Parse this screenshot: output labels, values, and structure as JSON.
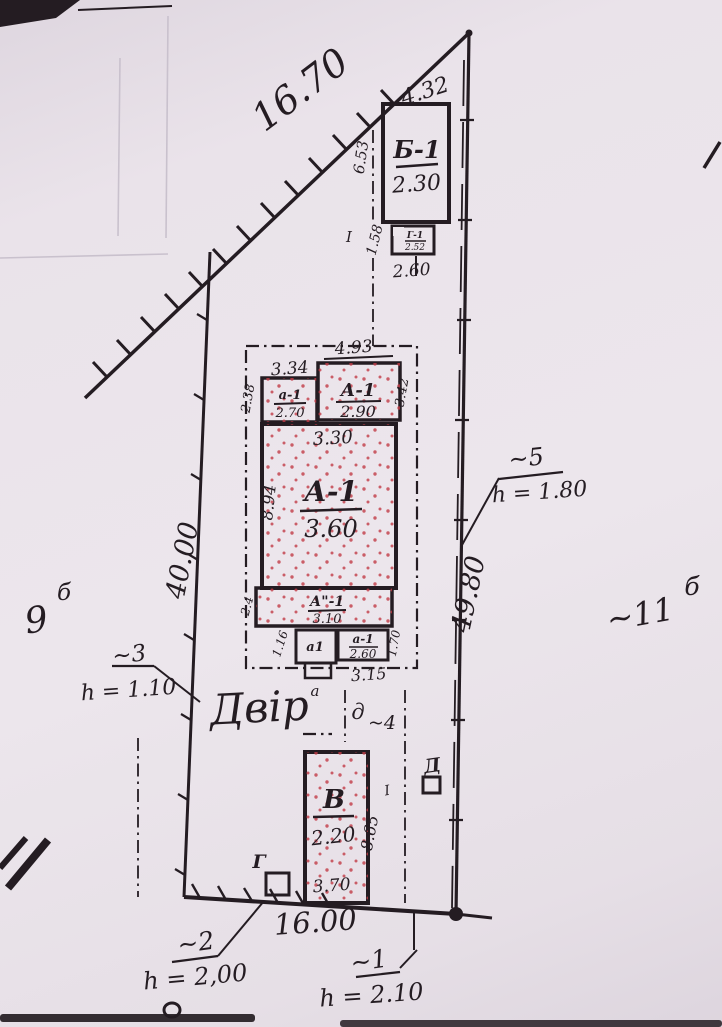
{
  "plot": {
    "dims": {
      "top": "16.70",
      "top_right": "4.32",
      "left": "40.00",
      "right": "49.80",
      "bottom": "16.00"
    },
    "yard": "Двір",
    "neighbor_left": {
      "num": "9",
      "sup": "б"
    },
    "neighbor_right": {
      "num": "~11",
      "sup": "б"
    },
    "gate": {
      "letter": "д",
      "num": "~4"
    },
    "fences": {
      "f1": {
        "id": "~1",
        "h": "h = 2.10"
      },
      "f2": {
        "id": "~2",
        "h": "h = 2,00"
      },
      "f3": {
        "id": "~3",
        "h": "h = 1.10"
      },
      "f5": {
        "id": "~5",
        "h": "h = 1.80"
      }
    }
  },
  "buildings": {
    "b1": {
      "name": "Б-1",
      "val": "2.30",
      "dim_left": "6.53",
      "dim_side": "1.58",
      "dim_bottom": "2.60"
    },
    "summer": {
      "name": "Г-1",
      "val": "2.52"
    },
    "room_tl": {
      "name": "а-1",
      "val": "2.70",
      "dim_top": "3.34",
      "dim_left": "2.38"
    },
    "room_tr": {
      "name": "А-1",
      "val": "2.90",
      "dim_top": "4.93",
      "dim_right": "3.42"
    },
    "main": {
      "name": "А-1",
      "val": "3.60",
      "dim_top": "3.30",
      "dim_left": "8.94"
    },
    "strip": {
      "name": "А\"-1",
      "val": "3.10",
      "dim_left": "2.4"
    },
    "annex_left": {
      "name": "а1",
      "dim_left": "1.16"
    },
    "annex_right": {
      "name": "а-1",
      "val": "2.60",
      "dim_right": "1.70",
      "dim_bottom": "3.15"
    },
    "porch": {
      "name": "а"
    },
    "v": {
      "name": "В",
      "val": "2.20",
      "dim_bottom": "3.70",
      "dim_right": "8.65"
    },
    "shed_g": {
      "name": "Г"
    },
    "shed_d": {
      "name": "Д"
    },
    "marks": {
      "station": "I"
    }
  },
  "colors": {
    "ink": "#241c22",
    "paper": "#ece6ec",
    "pink": "#f3d5d9",
    "pink_light": "#efdadd",
    "yellow": "#ded455",
    "gray": "#e1dcde",
    "dots": "#c23a46"
  }
}
